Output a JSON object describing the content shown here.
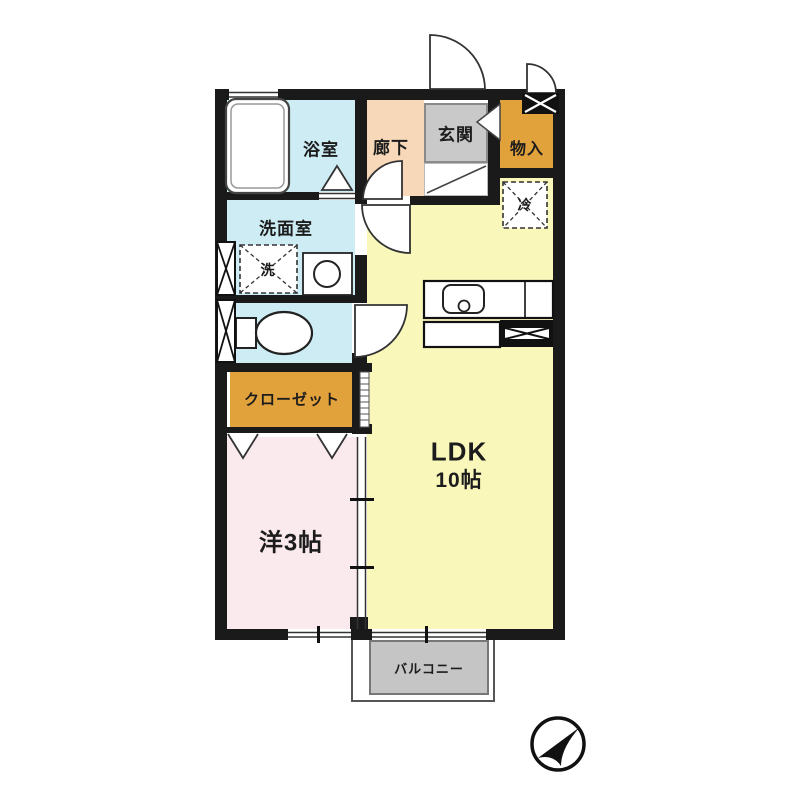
{
  "plan": {
    "title": "1LDK apartment floor plan",
    "rooms": {
      "bathroom": "浴室",
      "washroom": "洗面室",
      "washer": "洗",
      "hallway": "廊下",
      "entrance": "玄関",
      "storage": "物入",
      "fridge": "冷",
      "closet": "クローゼット",
      "western_room": "洋3帖",
      "ldk_label": "LDK",
      "ldk_size": "10帖",
      "balcony": "バルコニー"
    },
    "icons": {
      "compass": "compass-arrow-northeast"
    },
    "colors": {
      "wall": "#1a1a1a",
      "water_rooms": "#cdecf4",
      "hallway": "#f7d8b9",
      "entrance_gray": "#c9c9c9",
      "storage_orange": "#e2a23b",
      "ldk_yellow": "#faf7bb",
      "bedroom_pink": "#fae9ed",
      "balcony_gray": "#c5c5c5"
    }
  }
}
